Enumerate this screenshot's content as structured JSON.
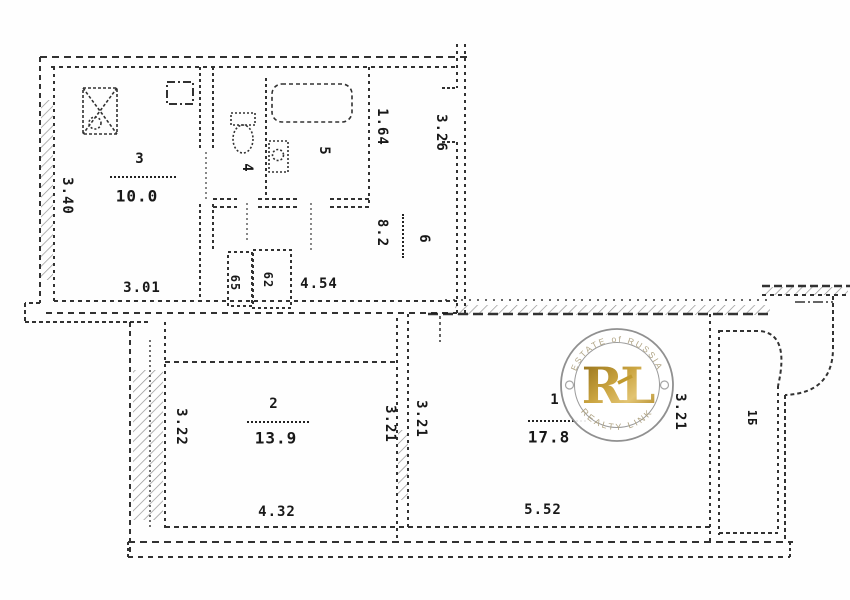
{
  "plan": {
    "title": "apartment-floor-plan",
    "rooms": {
      "kitchen": {
        "number": "3",
        "area": "10.0"
      },
      "wc": {
        "number": "4"
      },
      "bathroom": {
        "number": "5"
      },
      "hallway": {
        "number": "6",
        "area": "8.2"
      },
      "room2": {
        "number": "2",
        "area": "13.9"
      },
      "room1": {
        "number": "1",
        "area": "17.8"
      },
      "balcony": {
        "label": "1Б"
      }
    },
    "dimensions": {
      "kitchen_width": "3.40",
      "kitchen_length": "3.01",
      "hall_top": "1.64",
      "hall_side": "3.26",
      "hall_width": "4.54",
      "closet_left": "65",
      "closet_right": "62",
      "room2_left": "3.22",
      "room2_right": "3.21",
      "room2_bottom": "4.32",
      "room1_left": "3.21",
      "room1_right": "3.21",
      "room1_bottom": "5.52"
    },
    "icons": {
      "kitchen_sink": "rect-with-cross-and-circle",
      "bathtub": "rounded-rect",
      "toilet": "tank-and-bowl",
      "washbasin": "rect-with-circle",
      "vent_shaft": "dash-dot-box"
    },
    "watermark": {
      "arc_top": "ESTATE of RUSSIA",
      "monogram": "RL",
      "arc_bottom": "REALTY LINK",
      "gold": "#c29a33",
      "ring_gray": "#909090"
    }
  }
}
